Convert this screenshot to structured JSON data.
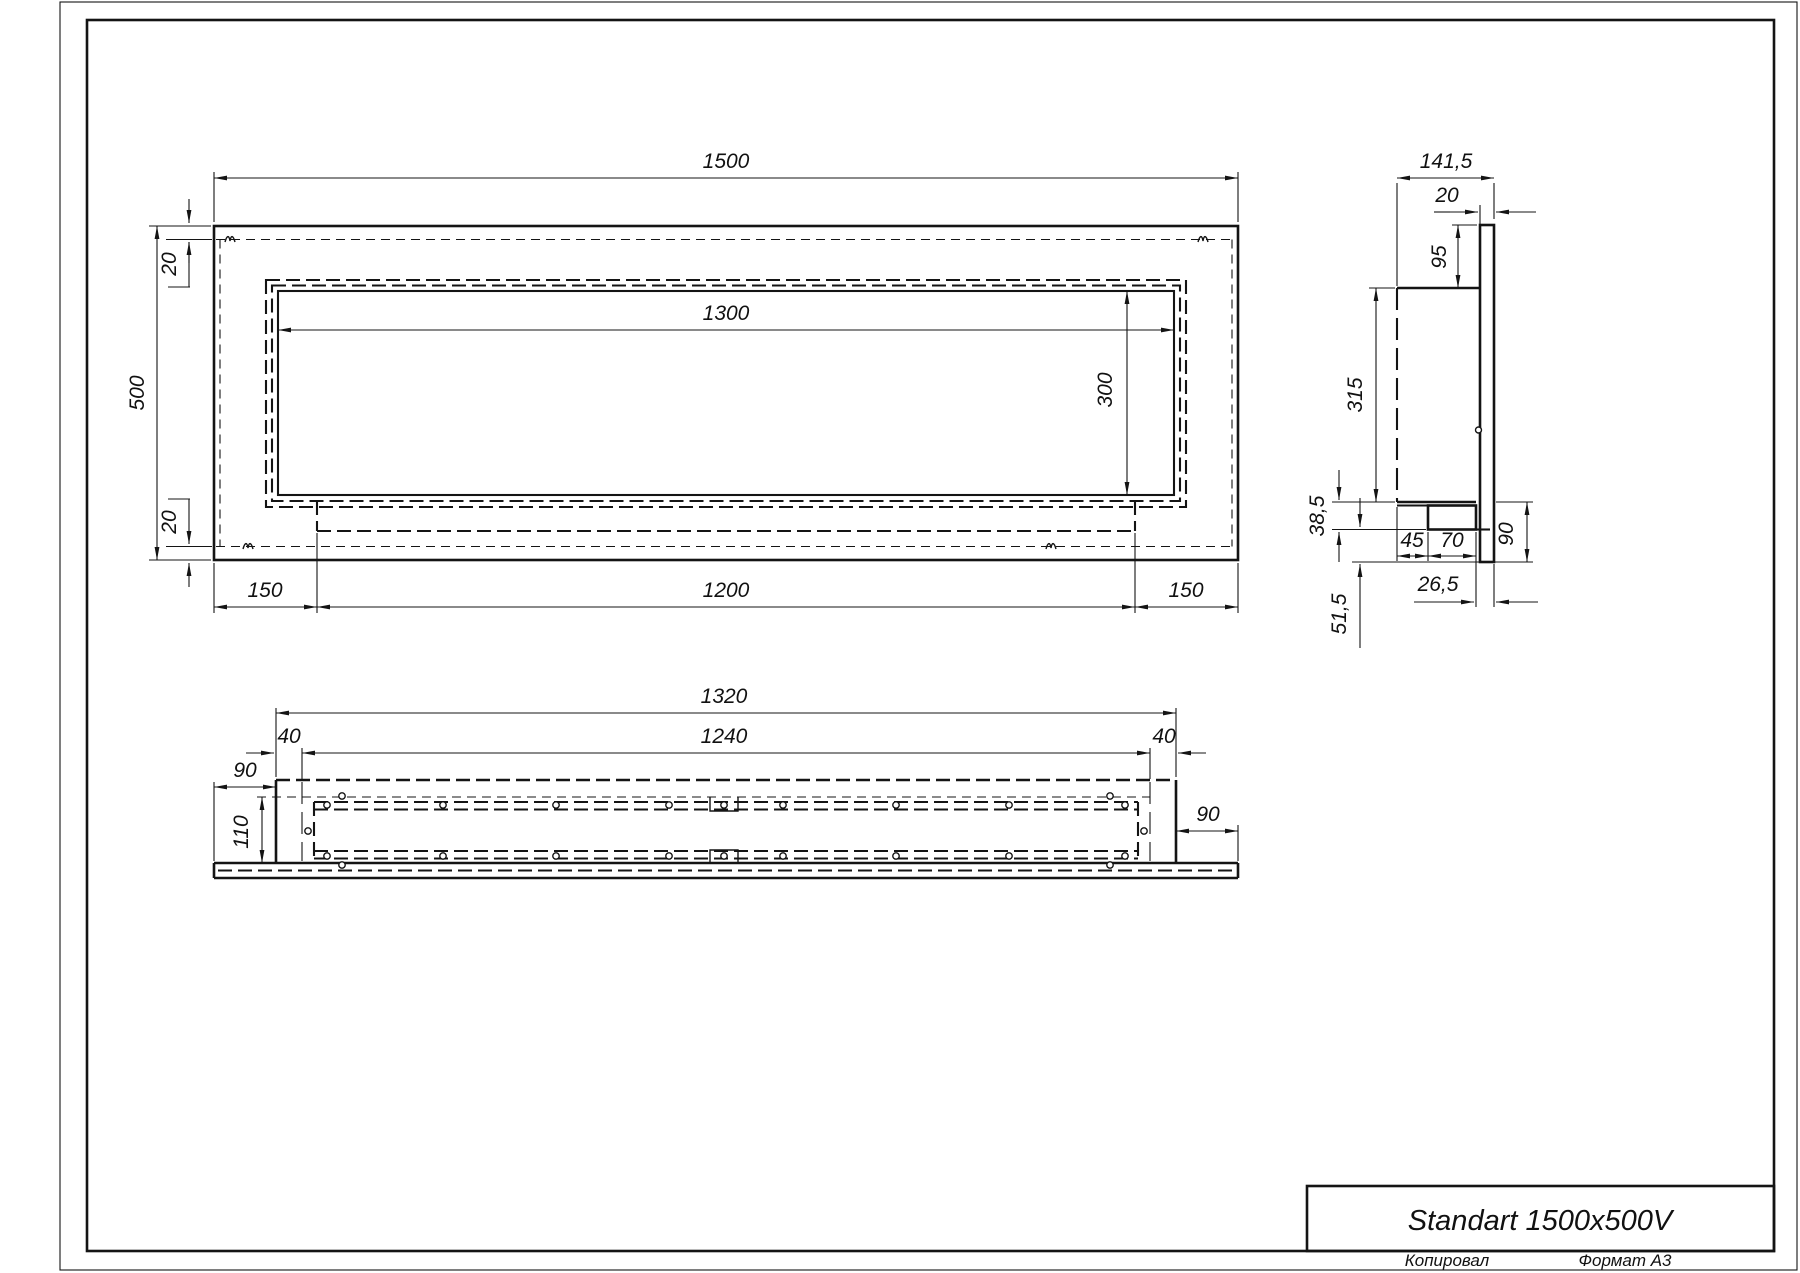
{
  "title_block": {
    "title": "Standart 1500x500V",
    "copied_by_label": "Копировал",
    "format_label": "Формат А3"
  },
  "front_view": {
    "dims": {
      "overall_width": "1500",
      "overall_height": "500",
      "edge_top": "20",
      "edge_bottom": "20",
      "opening_width": "1300",
      "opening_height": "300",
      "margin_left": "150",
      "hidden_body_width": "1200",
      "margin_right": "150"
    }
  },
  "side_view": {
    "dims": {
      "overall_depth": "141,5",
      "front_plate_thickness": "20",
      "top_offset": "95",
      "body_height": "315",
      "foot_height": "38,5",
      "foot_inset": "45",
      "foot_depth": "70",
      "bottom_overhang": "90",
      "foot_gap": "26,5",
      "bottom_lip": "51,5"
    }
  },
  "bottom_view": {
    "dims": {
      "body_width": "1320",
      "slot_width": "1240",
      "flange_left": "40",
      "flange_right": "40",
      "plate_overhang_left": "90",
      "channel_depth": "110",
      "plate_overhang_right": "90"
    }
  }
}
